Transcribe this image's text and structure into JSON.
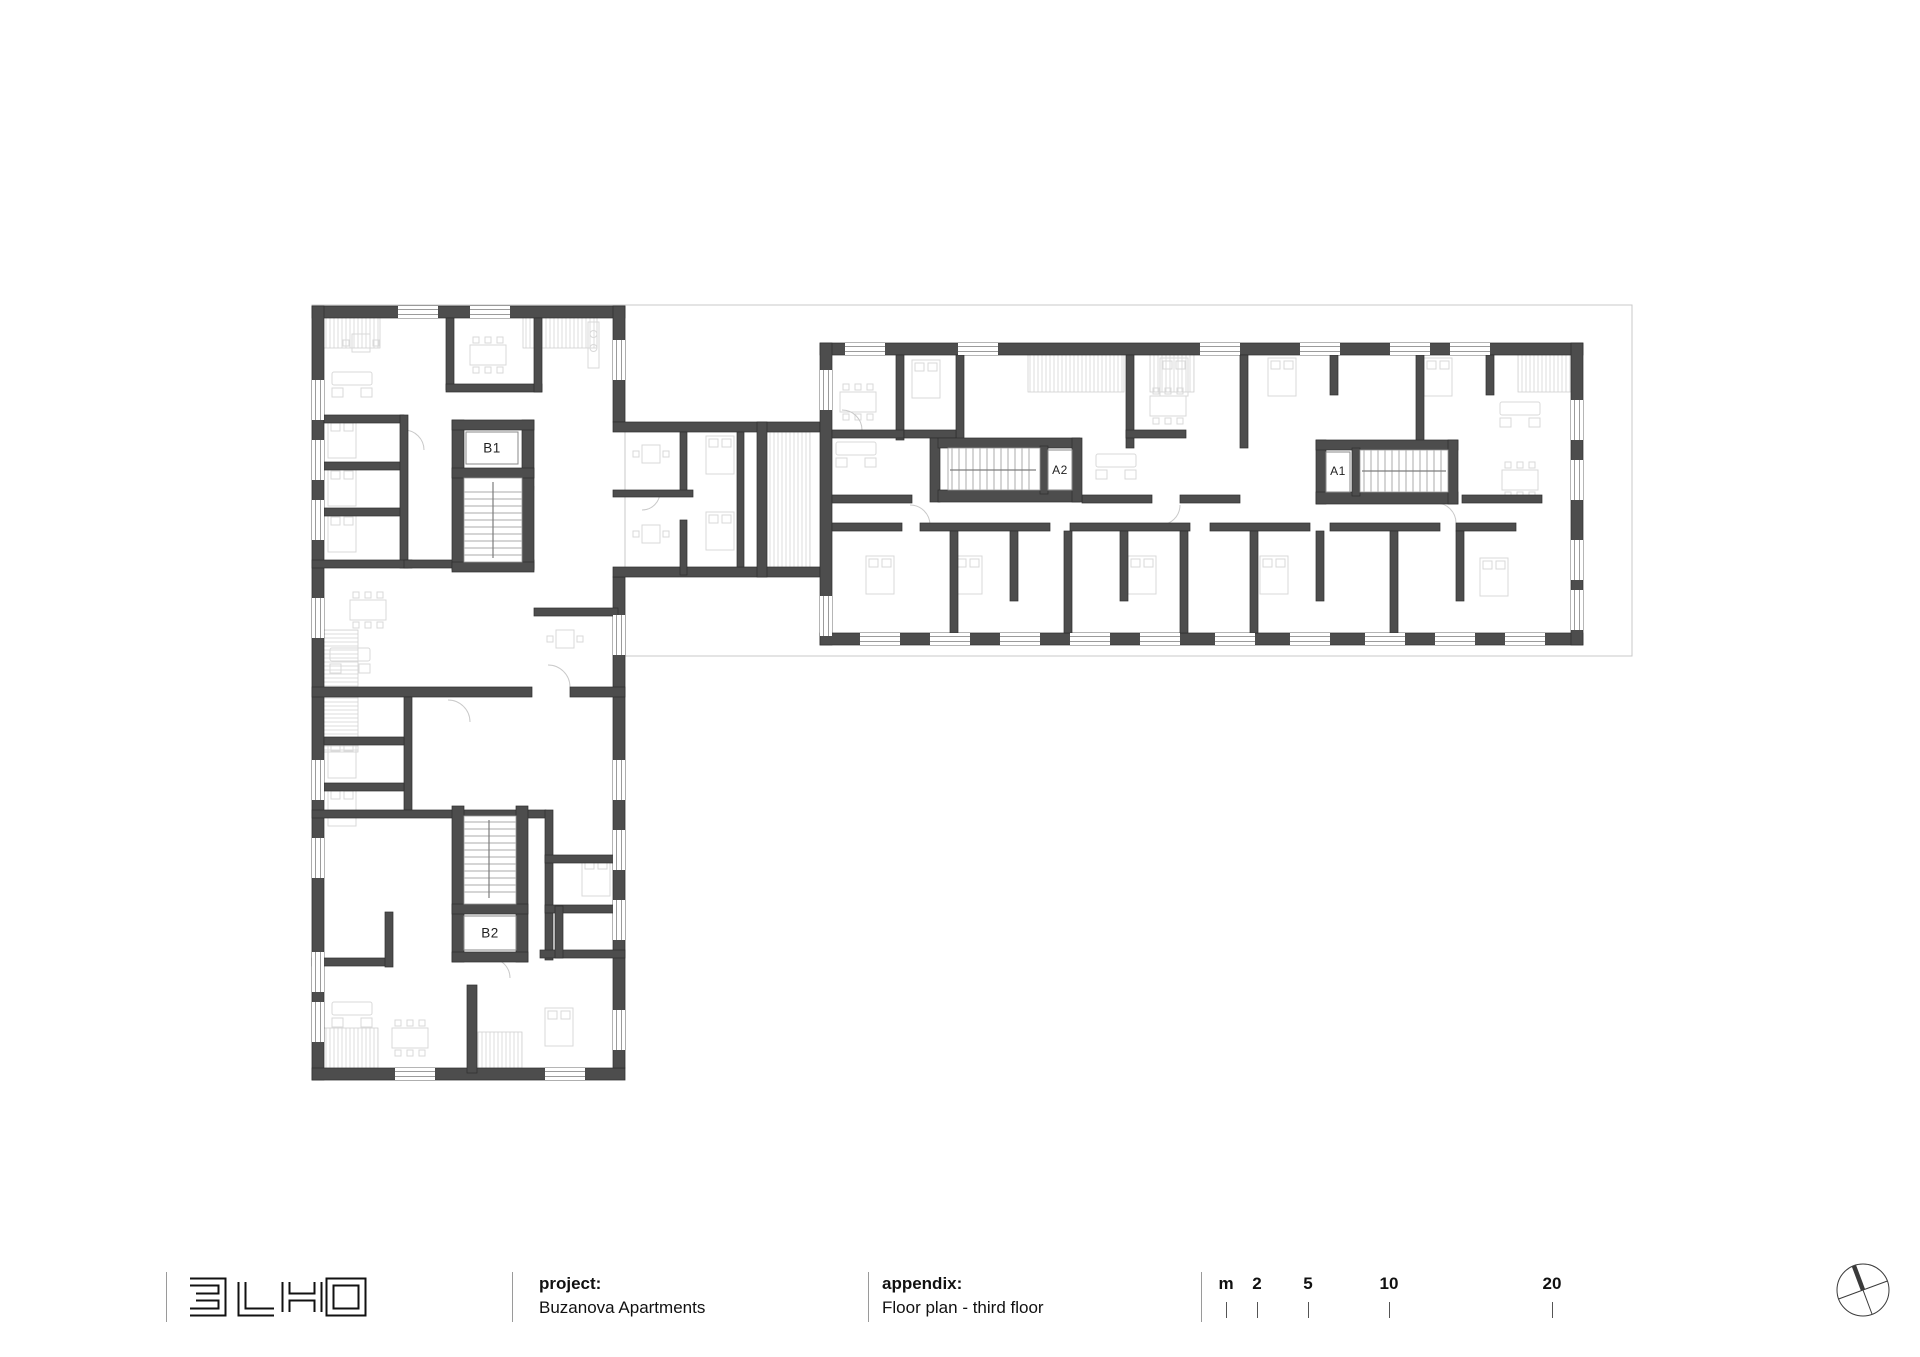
{
  "plan": {
    "units": [
      {
        "label": "B1"
      },
      {
        "label": "A2"
      },
      {
        "label": "A1"
      },
      {
        "label": "B2"
      }
    ]
  },
  "footer": {
    "logo": "3LHD",
    "project": {
      "label": "project:",
      "value": "Buzanova Apartments"
    },
    "appendix": {
      "label": "appendix:",
      "value": "Floor plan - third floor"
    },
    "scale_bar": {
      "unit": "m",
      "marks": [
        "2",
        "5",
        "10",
        "20"
      ]
    }
  },
  "colors": {
    "wall": "#4d4d4d",
    "boundary": "#c9c9c9",
    "furniture": "#d9d9d9",
    "hatch": "#d4d4d4",
    "ink": "#111111"
  },
  "icons": {
    "north_arrow": "compass-circle-with-crossed-lines"
  }
}
